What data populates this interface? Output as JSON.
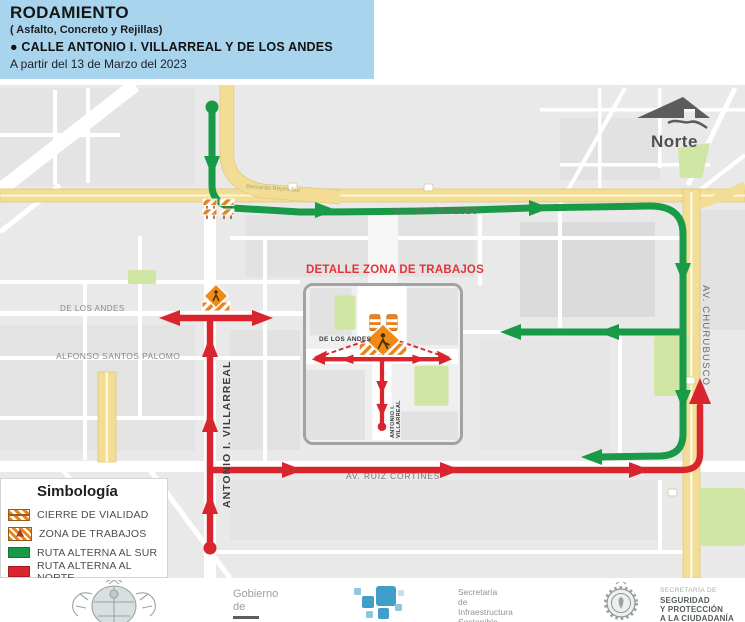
{
  "header": {
    "title": "RODAMIENTO",
    "subtitle": "( Asfalto, Concreto y Rejillas)",
    "street_line": "● CALLE ANTONIO I. VILLARREAL Y DE LOS ANDES",
    "date_line": "A partir del 13 de Marzo del 2023",
    "bg_color": "#a9d4ee"
  },
  "map": {
    "north_label": "Norte",
    "street_labels": {
      "los_angeles": "AV. LOS ÁNGELES",
      "de_los_andes": "DE LOS ANDES",
      "alfonso": "ALFONSO SANTOS PALOMO",
      "villarreal": "ANTONIO I. VILLARREAL",
      "ruiz_cortines": "AV. RUIZ CORTINES",
      "churubusco": "AV. CHURUBUSCO",
      "bernardo": "Bernardo Reyes Sur"
    },
    "colors": {
      "route_south_green": "#189a47",
      "route_north_red": "#d9252e",
      "road_yellow": "#f3dd95",
      "park_green": "#cfe6a4",
      "map_bg": "#e9e9e9"
    },
    "icons": {
      "north": "north-arrow-icon",
      "closure": "barrier-icon",
      "workzone": "roadwork-icon"
    }
  },
  "detail_inset": {
    "title": "DETALLE ZONA DE TRABAJOS",
    "street_h": "DE LOS ANDES",
    "street_v": "ANTONIO I. VILLARREAL"
  },
  "legend": {
    "title": "Simbología",
    "items": [
      {
        "label": "CIERRE DE VIALIDAD",
        "icon": "barrier-icon"
      },
      {
        "label": "ZONA DE TRABAJOS",
        "icon": "roadwork-icon"
      },
      {
        "label": "RUTA ALTERNA AL SUR",
        "icon": "green-swatch",
        "color": "#189a47"
      },
      {
        "label": "RUTA ALTERNA AL NORTE",
        "icon": "red-swatch",
        "color": "#d9252e"
      }
    ]
  },
  "footer": {
    "gov": {
      "line1": "Gobierno",
      "line2": "de"
    },
    "infra": {
      "line1": "Secretaría",
      "line2": "de",
      "line3": "Infraestructura",
      "line4": "Sostenible"
    },
    "security": {
      "line1": "SECRETARÍA DE",
      "line2": "SEGURIDAD",
      "line3": "Y PROTECCIÓN",
      "line4": "A LA CIUDADANÍA"
    }
  }
}
